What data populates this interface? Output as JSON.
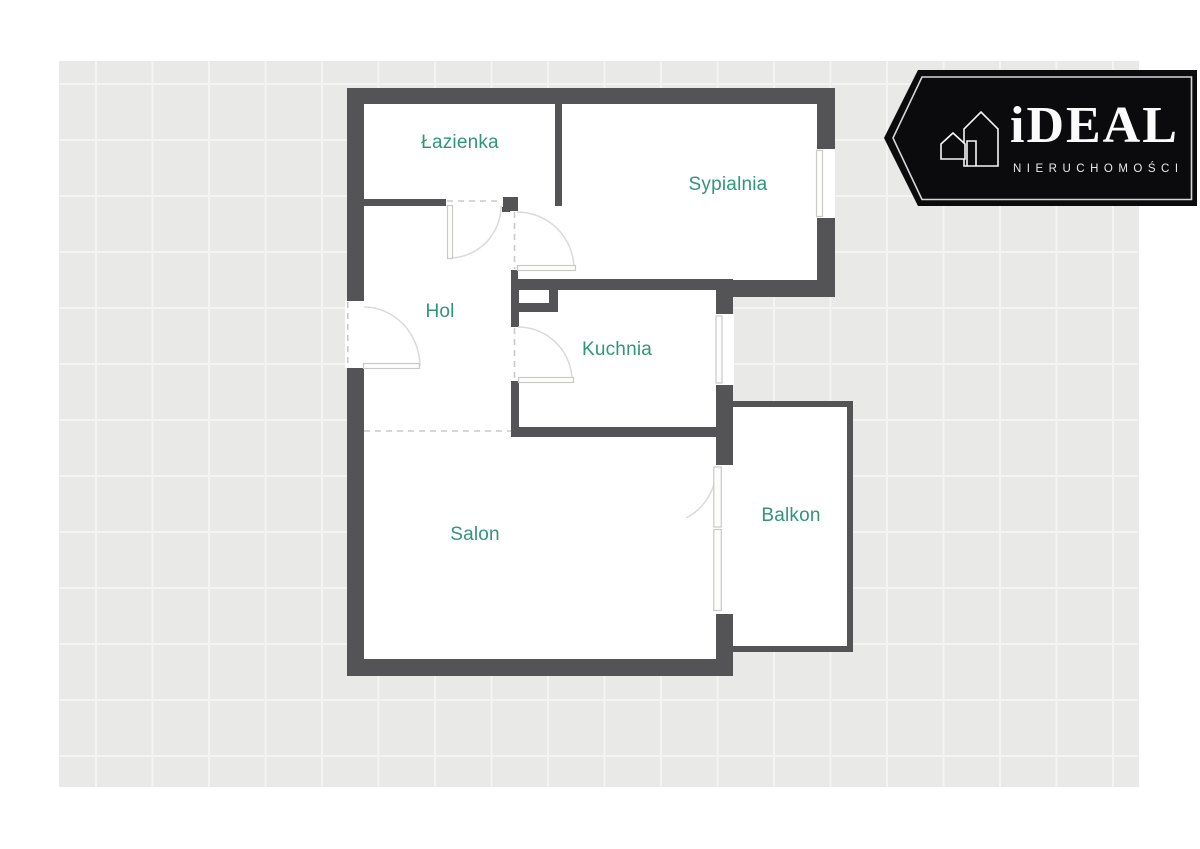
{
  "page": {
    "background": "#ffffff"
  },
  "canvas": {
    "background": "#e9e9e7",
    "grid_line_color": "#f4f4f2",
    "grid_cell_px": 56
  },
  "palette": {
    "wall": "#545456",
    "room_fill": "#ffffff",
    "label_text": "#319578",
    "door_swing_line": "#dadad8",
    "opening_frame_line": "#c9c9c7",
    "dashed_line": "#c9c9c7"
  },
  "floorplan": {
    "rooms": [
      {
        "id": "lazienka",
        "label": "Łazienka"
      },
      {
        "id": "sypialnia",
        "label": "Sypialnia"
      },
      {
        "id": "hol",
        "label": "Hol"
      },
      {
        "id": "kuchnia",
        "label": "Kuchnia"
      },
      {
        "id": "salon",
        "label": "Salon"
      },
      {
        "id": "balkon",
        "label": "Balkon"
      }
    ],
    "features": [
      "entrance-door",
      "bathroom-door",
      "bedroom-door",
      "kitchen-door",
      "bedroom-window",
      "kitchen-window",
      "balcony-door",
      "balcony-window",
      "hol-salon-dashed-boundary"
    ]
  },
  "logo": {
    "brand": "iDEAL",
    "subtitle": "NIERUCHOMOŚCI",
    "icon": "house-outline-icon",
    "badge_color": "#0b0b0d",
    "inner_border_color": "#d6d6d6",
    "text_color": "#fbfbfb"
  }
}
